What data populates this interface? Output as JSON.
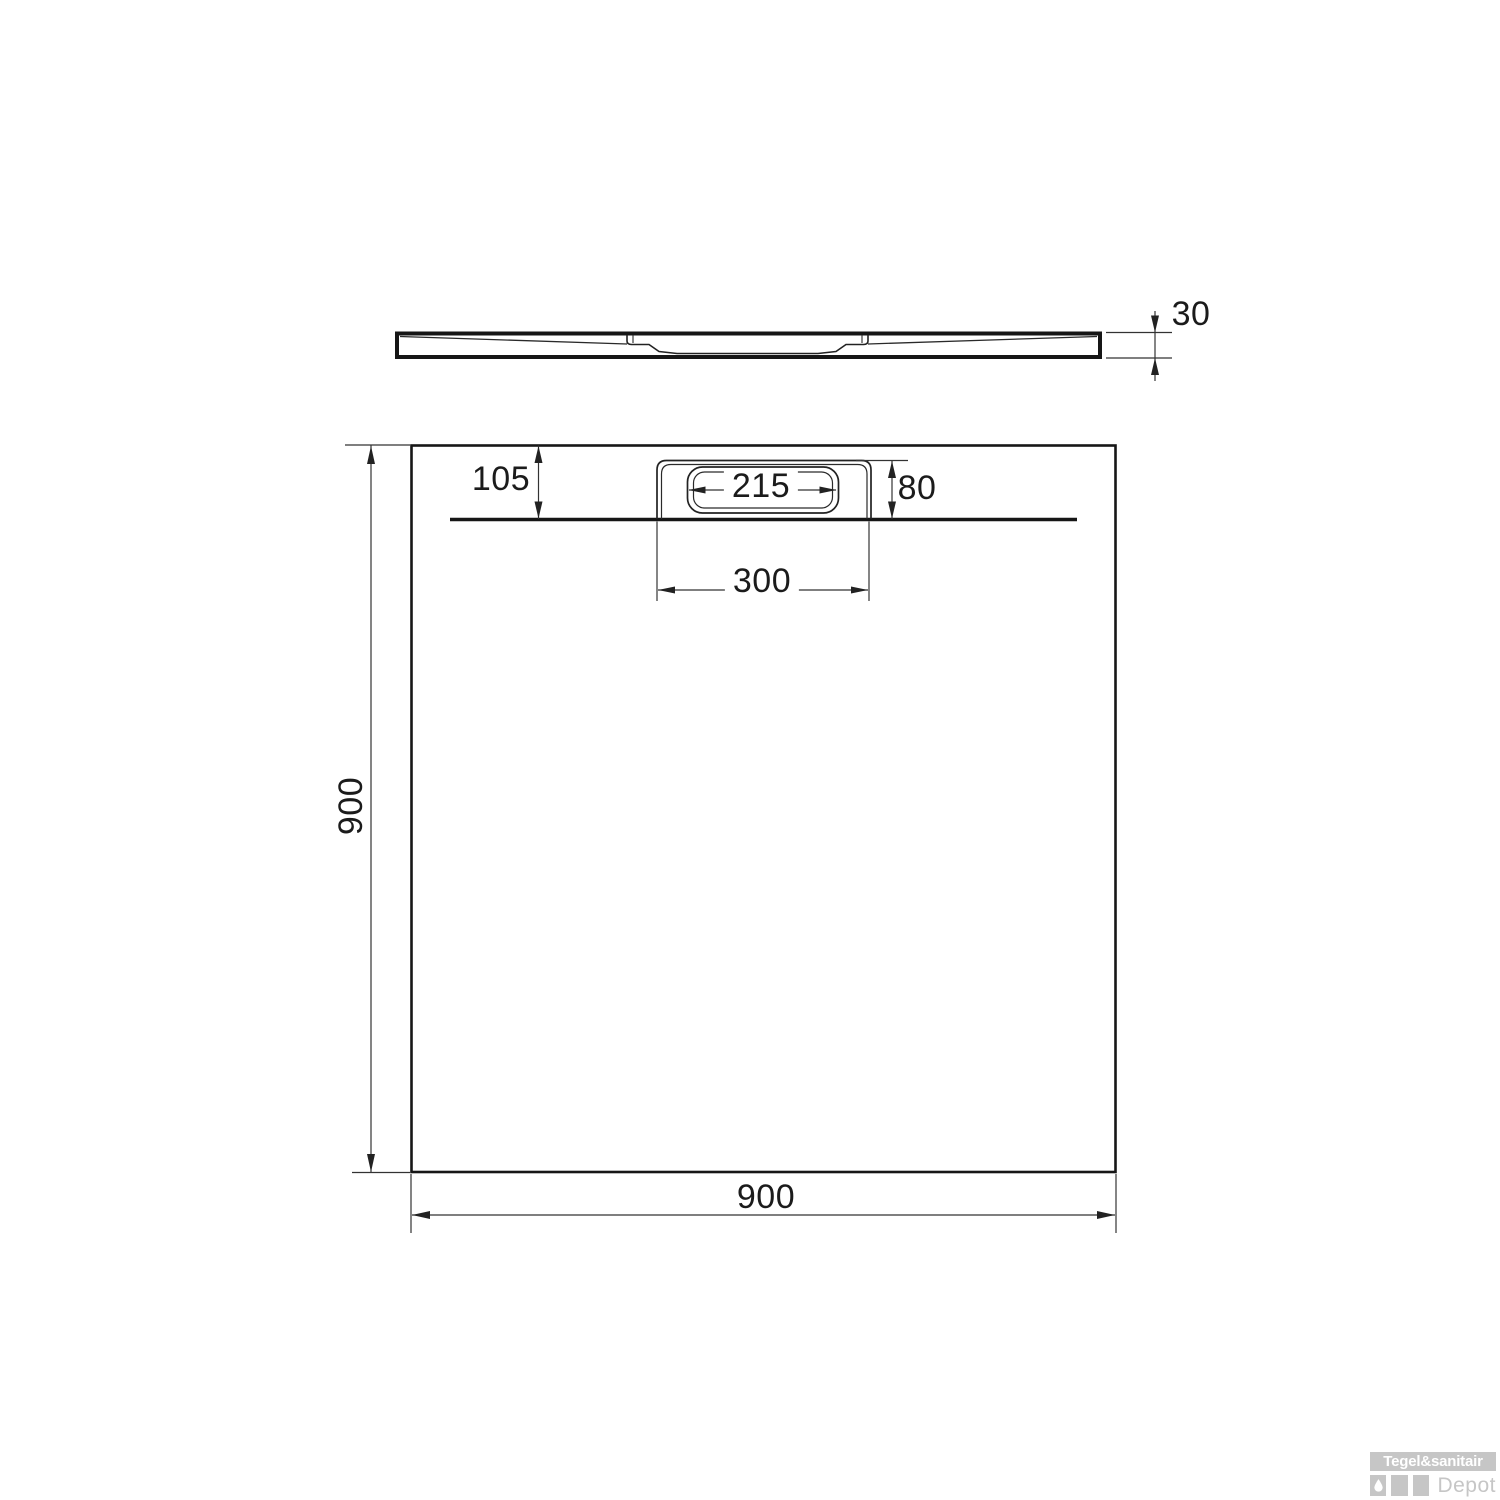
{
  "page": {
    "background": "#ffffff"
  },
  "side_view": {
    "description": "shower tray profile side view",
    "thickness_label": "30"
  },
  "top_view": {
    "description": "shower tray top view with drain",
    "edge_to_drain_label": "105",
    "drain_inner_width_label": "215",
    "drain_depth_label": "80",
    "drain_outer_width_label": "300",
    "height_label": "900",
    "width_label": "900"
  },
  "watermark": {
    "brand_text": "Tegel&sanitair",
    "depot_text": "Depot",
    "drop_icon": "water-drop"
  },
  "colors": {
    "outline": "#161616",
    "dimension_line": "#333333",
    "watermark_gray": "#c6c6c6"
  }
}
